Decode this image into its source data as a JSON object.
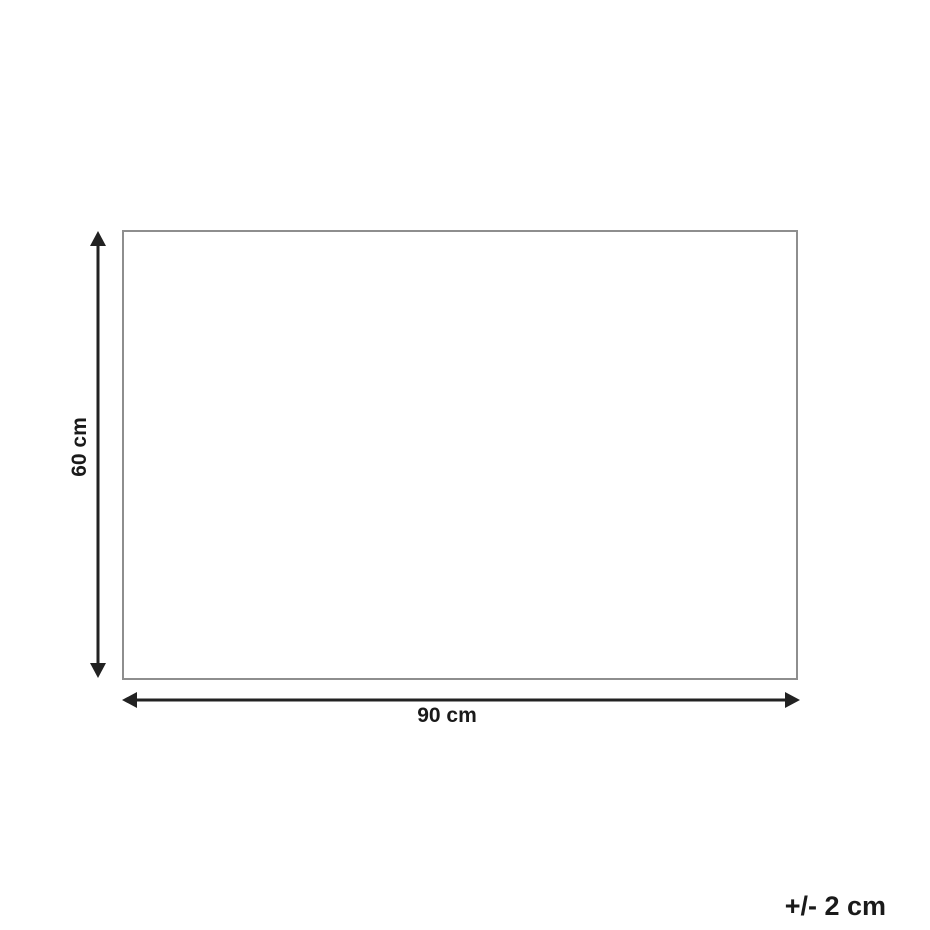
{
  "diagram": {
    "shape": "rectangle",
    "height_label": "60 cm",
    "width_label": "90 cm",
    "height_value_cm": 60,
    "width_value_cm": 90,
    "tolerance_label": "+/- 2 cm"
  },
  "colors": {
    "bg": "#ffffff",
    "rect-border": "#8e8e8e",
    "arrow": "#222222",
    "text": "#1a1a1a"
  }
}
